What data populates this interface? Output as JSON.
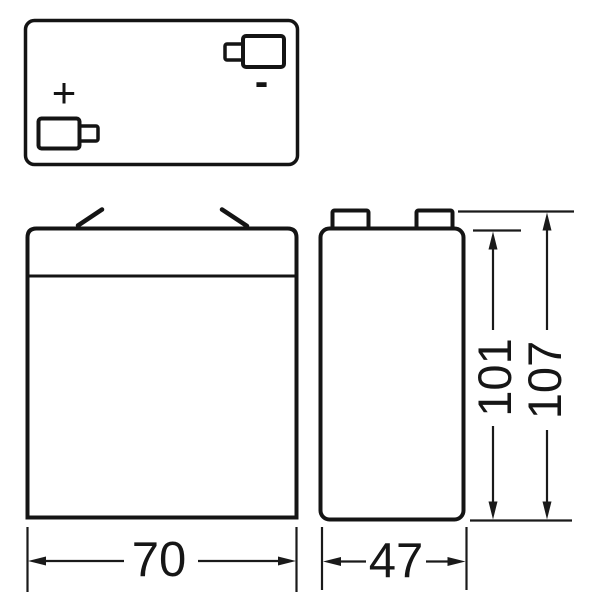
{
  "drawing": {
    "subject": "battery-dimension-drawing",
    "dimensions": {
      "width": "70",
      "depth": "47",
      "body_height": "101",
      "overall_height": "107"
    },
    "polarity": {
      "positive": "+",
      "negative": "-"
    }
  },
  "colors": {
    "background": "#ffffff",
    "outline": "#141414",
    "dimension_line": "#1a1a1a",
    "text": "#161616"
  }
}
